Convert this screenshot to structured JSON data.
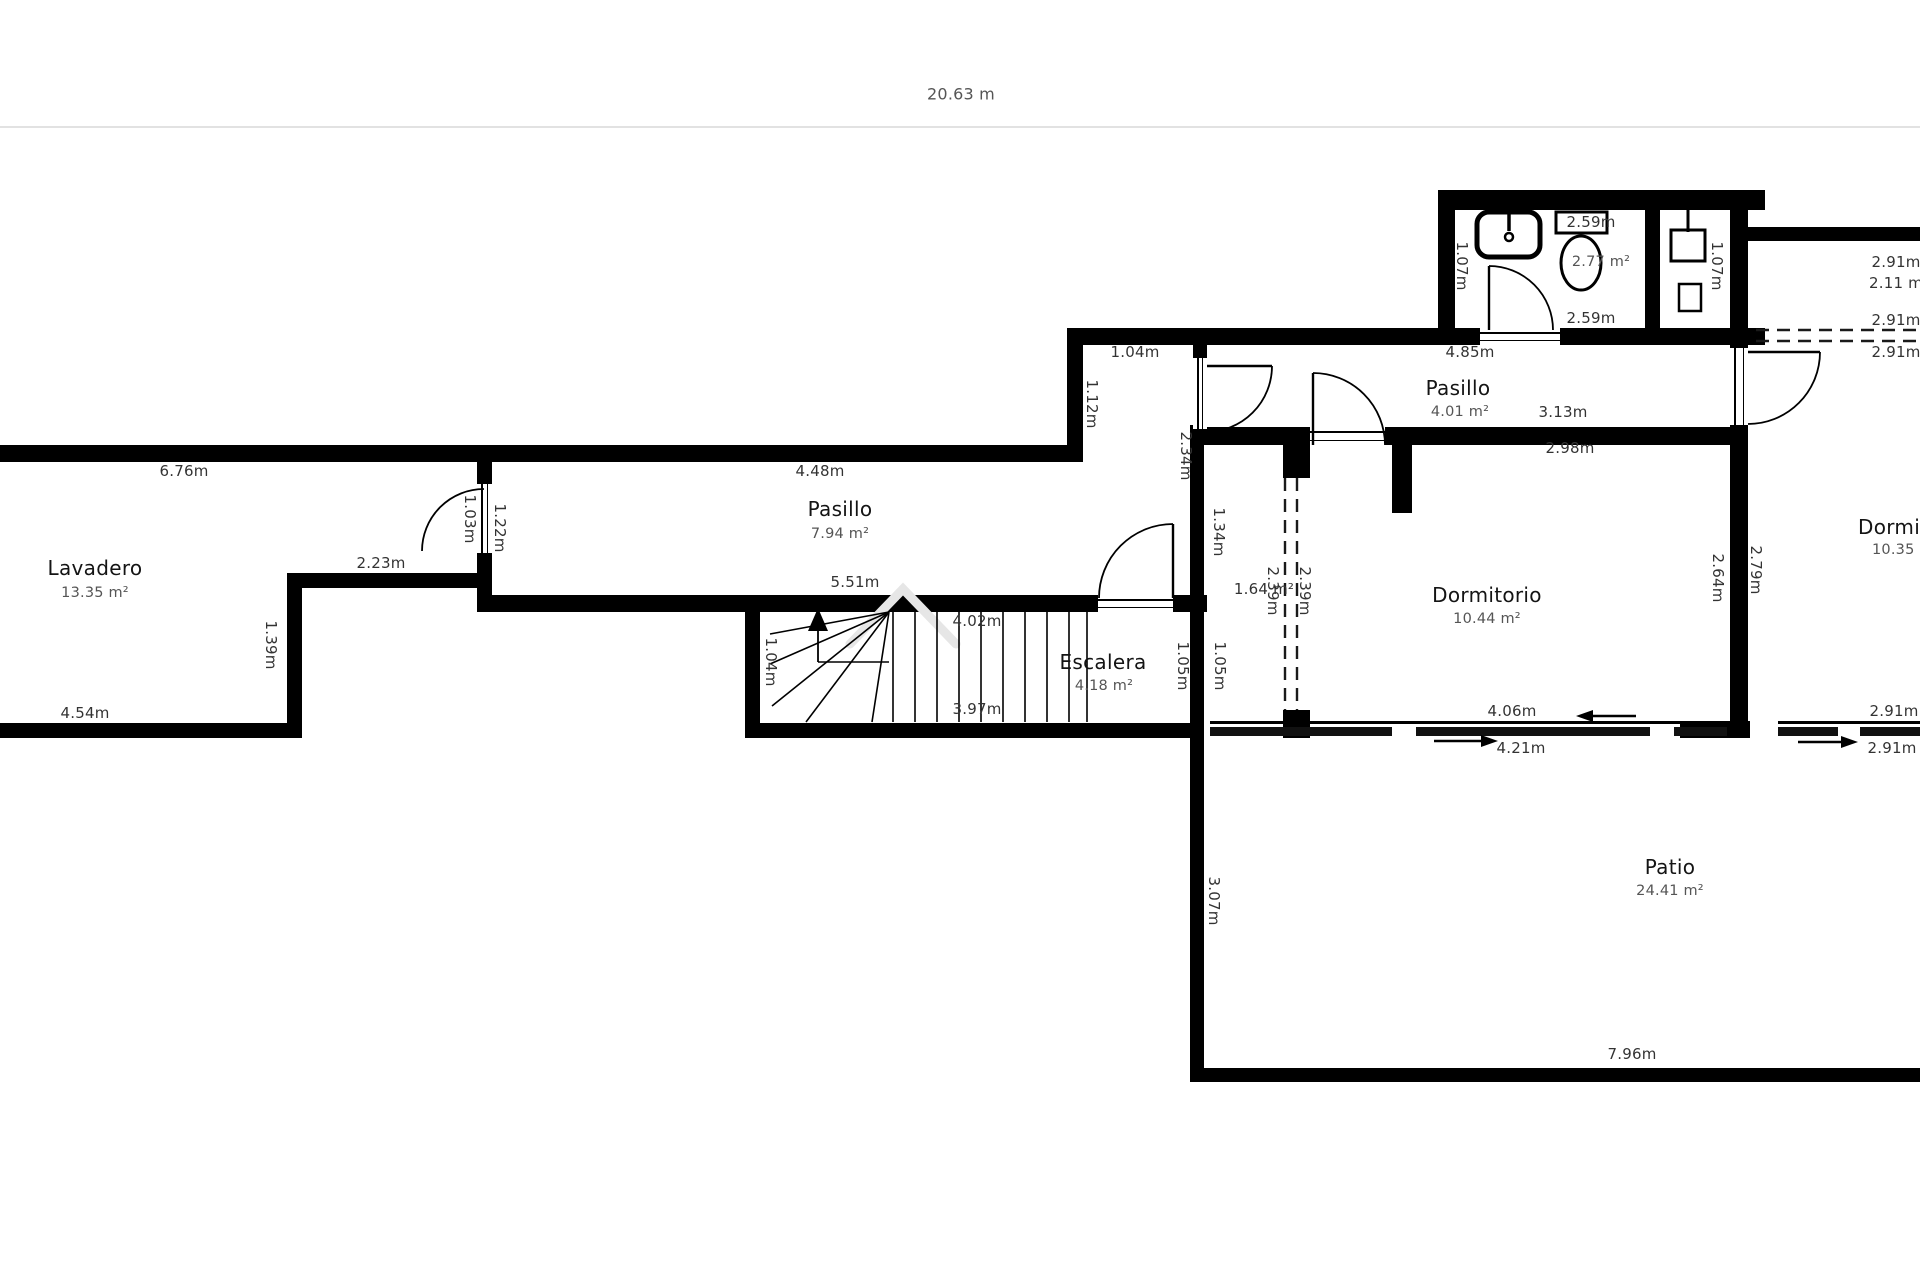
{
  "header": {
    "total_width_label": "20.63 m"
  },
  "rooms": [
    {
      "name": "Lavadero",
      "area": "13.35 m²"
    },
    {
      "name": "Pasillo",
      "area": "7.94 m²"
    },
    {
      "name": "Escalera",
      "area": "4.18 m²"
    },
    {
      "name": "Pasillo",
      "area": "4.01 m²"
    },
    {
      "name": "Dormitorio",
      "area": "10.44 m²"
    },
    {
      "name": "Dormitorio",
      "area": "10.35 m²"
    },
    {
      "name": "Patio",
      "area": "24.41 m²"
    },
    {
      "name": "Baño",
      "area": "2.77 m²"
    }
  ],
  "labels": [
    {
      "t": "6.76m",
      "x": 184,
      "y": 471
    },
    {
      "t": "Lavadero",
      "x": 95,
      "y": 568,
      "c": "room"
    },
    {
      "t": "13.35 m²",
      "x": 95,
      "y": 593,
      "c": "area"
    },
    {
      "t": "4.54m",
      "x": 85,
      "y": 713
    },
    {
      "t": "2.23m",
      "x": 381,
      "y": 563
    },
    {
      "t": "1.03m",
      "x": 470,
      "y": 519,
      "r": 1
    },
    {
      "t": "1.22m",
      "x": 500,
      "y": 528,
      "r": 1
    },
    {
      "t": "1.39m",
      "x": 271,
      "y": 645,
      "r": 1
    },
    {
      "t": "4.48m",
      "x": 820,
      "y": 471
    },
    {
      "t": "Pasillo",
      "x": 840,
      "y": 509,
      "c": "room"
    },
    {
      "t": "7.94 m²",
      "x": 840,
      "y": 534,
      "c": "area"
    },
    {
      "t": "5.51m",
      "x": 855,
      "y": 582
    },
    {
      "t": "4.02m",
      "x": 977,
      "y": 621
    },
    {
      "t": "3.97m",
      "x": 977,
      "y": 709
    },
    {
      "t": "Escalera",
      "x": 1103,
      "y": 662,
      "c": "room"
    },
    {
      "t": "4.18 m²",
      "x": 1104,
      "y": 686,
      "c": "area"
    },
    {
      "t": "1.04m",
      "x": 771,
      "y": 662,
      "r": 1
    },
    {
      "t": "1.05m",
      "x": 1183,
      "y": 666,
      "r": 1
    },
    {
      "t": "1.05m",
      "x": 1220,
      "y": 666,
      "r": 1
    },
    {
      "t": "1.04m",
      "x": 1135,
      "y": 352
    },
    {
      "t": "1.12m",
      "x": 1092,
      "y": 404,
      "r": 1
    },
    {
      "t": "2.34m",
      "x": 1186,
      "y": 456,
      "r": 1
    },
    {
      "t": "4.85m",
      "x": 1470,
      "y": 352
    },
    {
      "t": "Pasillo",
      "x": 1458,
      "y": 388,
      "c": "room"
    },
    {
      "t": "4.01 m²",
      "x": 1460,
      "y": 412,
      "c": "area"
    },
    {
      "t": "3.13m",
      "x": 1563,
      "y": 412
    },
    {
      "t": "2.59m",
      "x": 1591,
      "y": 222
    },
    {
      "t": "2.77 m²",
      "x": 1601,
      "y": 262,
      "c": "area"
    },
    {
      "t": "2.59m",
      "x": 1591,
      "y": 318
    },
    {
      "t": "1.07m",
      "x": 1462,
      "y": 266,
      "r": 1
    },
    {
      "t": "1.07m",
      "x": 1717,
      "y": 266,
      "r": 1
    },
    {
      "t": "2.91m",
      "x": 1896,
      "y": 262
    },
    {
      "t": "2.11 m²",
      "x": 1869,
      "y": 283,
      "a": "l"
    },
    {
      "t": "2.91m",
      "x": 1896,
      "y": 320
    },
    {
      "t": "2.91m",
      "x": 1896,
      "y": 352
    },
    {
      "t": "2.98m",
      "x": 1570,
      "y": 448
    },
    {
      "t": "Dormitorio",
      "x": 1487,
      "y": 595,
      "c": "room"
    },
    {
      "t": "10.44 m²",
      "x": 1487,
      "y": 619,
      "c": "area"
    },
    {
      "t": "2.64m",
      "x": 1718,
      "y": 578,
      "r": 1
    },
    {
      "t": "2.79m",
      "x": 1756,
      "y": 570,
      "r": 1
    },
    {
      "t": "1.34m",
      "x": 1219,
      "y": 532,
      "r": 1
    },
    {
      "t": "1.64 m²",
      "x": 1264,
      "y": 589
    },
    {
      "t": "2.39m",
      "x": 1273,
      "y": 591,
      "r": 1
    },
    {
      "t": "2.39m",
      "x": 1305,
      "y": 591,
      "r": 1
    },
    {
      "t": "Dormitorio",
      "x": 1858,
      "y": 527,
      "c": "room",
      "a": "l"
    },
    {
      "t": "10.35 m²",
      "x": 1872,
      "y": 550,
      "c": "area",
      "a": "l"
    },
    {
      "t": "4.06m",
      "x": 1512,
      "y": 711
    },
    {
      "t": "4.21m",
      "x": 1521,
      "y": 748
    },
    {
      "t": "2.91m",
      "x": 1894,
      "y": 711
    },
    {
      "t": "2.91m",
      "x": 1892,
      "y": 748
    },
    {
      "t": "Patio",
      "x": 1670,
      "y": 867,
      "c": "room"
    },
    {
      "t": "24.41 m²",
      "x": 1670,
      "y": 891,
      "c": "area"
    },
    {
      "t": "7.96m",
      "x": 1632,
      "y": 1054
    },
    {
      "t": "3.07m",
      "x": 1214,
      "y": 901,
      "r": 1
    }
  ],
  "plan": {
    "walls": [
      [
        1438,
        190,
        327,
        20
      ],
      [
        1438,
        190,
        17,
        155
      ],
      [
        1067,
        328,
        413,
        17
      ],
      [
        1560,
        328,
        205,
        17
      ],
      [
        1645,
        210,
        15,
        120
      ],
      [
        1730,
        190,
        18,
        158
      ],
      [
        1730,
        425,
        18,
        297
      ],
      [
        1748,
        227,
        172,
        14
      ],
      [
        1067,
        328,
        16,
        117
      ],
      [
        0,
        445,
        1083,
        17
      ],
      [
        477,
        445,
        15,
        39
      ],
      [
        477,
        553,
        15,
        59
      ],
      [
        287,
        573,
        203,
        15
      ],
      [
        287,
        573,
        15,
        165
      ],
      [
        0,
        723,
        302,
        15
      ],
      [
        477,
        595,
        621,
        17
      ],
      [
        1173,
        595,
        34,
        17
      ],
      [
        745,
        595,
        15,
        143
      ],
      [
        745,
        723,
        458,
        15
      ],
      [
        1193,
        328,
        14,
        32
      ],
      [
        1190,
        425,
        14,
        313
      ],
      [
        1190,
        735,
        14,
        347
      ],
      [
        1190,
        1068,
        730,
        14
      ],
      [
        1193,
        427,
        117,
        18
      ],
      [
        1385,
        427,
        363,
        18
      ],
      [
        1392,
        445,
        20,
        68
      ],
      [
        1283,
        445,
        27,
        33
      ],
      [
        1283,
        710,
        27,
        28
      ],
      [
        1680,
        721,
        70,
        17
      ]
    ],
    "gaps": [
      [
        1480,
        328,
        80,
        17,
        "h"
      ],
      [
        1193,
        358,
        14,
        71,
        "v"
      ],
      [
        1310,
        427,
        75,
        18,
        "h"
      ],
      [
        1730,
        348,
        18,
        77,
        "v"
      ],
      [
        477,
        484,
        15,
        69,
        "v"
      ],
      [
        1098,
        595,
        75,
        17,
        "h"
      ]
    ],
    "sliders": [
      {
        "line": [
          1210,
          721,
          517,
          3
        ],
        "band": [
          1210,
          727,
          517,
          9
        ],
        "slots": [
          [
            1392,
            727,
            24,
            9
          ],
          [
            1650,
            727,
            24,
            9
          ]
        ]
      },
      {
        "line": [
          1778,
          721,
          142,
          3
        ],
        "band": [
          1778,
          727,
          142,
          9
        ],
        "slots": [
          [
            1838,
            727,
            22,
            9
          ]
        ]
      }
    ],
    "doors": [
      {
        "leaf": "M1489,330 L1489,266",
        "arc": "M1489,266 A64,64 0 0 1 1553,330"
      },
      {
        "leaf": "M1207,366 L1272,366",
        "arc": "M1272,366 A66,66 0 0 1 1206,432"
      },
      {
        "leaf": "M1313,445 L1313,373",
        "arc": "M1313,373 A72,72 0 0 1 1385,445"
      },
      {
        "leaf": "M1748,352 L1820,352",
        "arc": "M1820,352 A72,72 0 0 1 1748,424"
      },
      {
        "leaf": "",
        "arc": "M484,489 A62,62 0 0 0 422,551"
      },
      {
        "leaf": "M1173,598 L1173,524",
        "arc": "M1099,598 A74,74 0 0 1 1173,524"
      }
    ],
    "dashed": [
      "M1285,478 L1285,710",
      "M1297,478 L1297,710",
      "M1756,330 L1920,330",
      "M1756,341 L1920,341"
    ],
    "stairs": {
      "tread_x": [
        893,
        915,
        937,
        959,
        981,
        1003,
        1025,
        1047,
        1069,
        1087
      ],
      "tread_y1": 612,
      "tread_y2": 722,
      "fan_apex": [
        889,
        612
      ],
      "fan_ends": [
        [
          770,
          634
        ],
        [
          770,
          664
        ],
        [
          772,
          706
        ],
        [
          806,
          722
        ],
        [
          872,
          722
        ]
      ],
      "up_arrow_tri": [
        [
          818,
          608
        ],
        [
          808,
          631
        ],
        [
          828,
          631
        ]
      ],
      "up_arrow_stem": [
        818,
        631,
        818,
        662
      ],
      "winder_line": [
        818,
        662,
        889,
        662
      ]
    },
    "fixtures": [
      {
        "k": "rrect",
        "x": 1477,
        "y": 212,
        "w": 63,
        "h": 45,
        "rx": 12,
        "sw": 5
      },
      {
        "k": "line",
        "x1": 1509,
        "y1": 213,
        "x2": 1509,
        "y2": 231,
        "sw": 3.5
      },
      {
        "k": "circle",
        "cx": 1509,
        "cy": 237,
        "r": 4,
        "sw": 2.5
      },
      {
        "k": "rect",
        "x": 1556,
        "y": 212,
        "w": 51,
        "h": 21,
        "sw": 3
      },
      {
        "k": "ellipse",
        "cx": 1581,
        "cy": 263,
        "rx": 20,
        "ry": 27,
        "sw": 3
      },
      {
        "k": "rect",
        "x": 1671,
        "y": 230,
        "w": 34,
        "h": 31,
        "sw": 3
      },
      {
        "k": "line",
        "x1": 1688,
        "y1": 210,
        "x2": 1688,
        "y2": 232,
        "sw": 3
      },
      {
        "k": "rect",
        "x": 1679,
        "y": 284,
        "w": 22,
        "h": 27,
        "sw": 2.5
      }
    ],
    "slide_arrows": [
      {
        "x1": 1636,
        "y1": 716,
        "x2": 1576,
        "y2": 716
      },
      {
        "x1": 1434,
        "y1": 741,
        "x2": 1498,
        "y2": 741
      },
      {
        "x1": 1798,
        "y1": 742,
        "x2": 1858,
        "y2": 742
      }
    ],
    "watermark": {
      "path": "M850,644 L903,589 L956,644",
      "sw": 9,
      "color": "#e6e6e6"
    }
  }
}
